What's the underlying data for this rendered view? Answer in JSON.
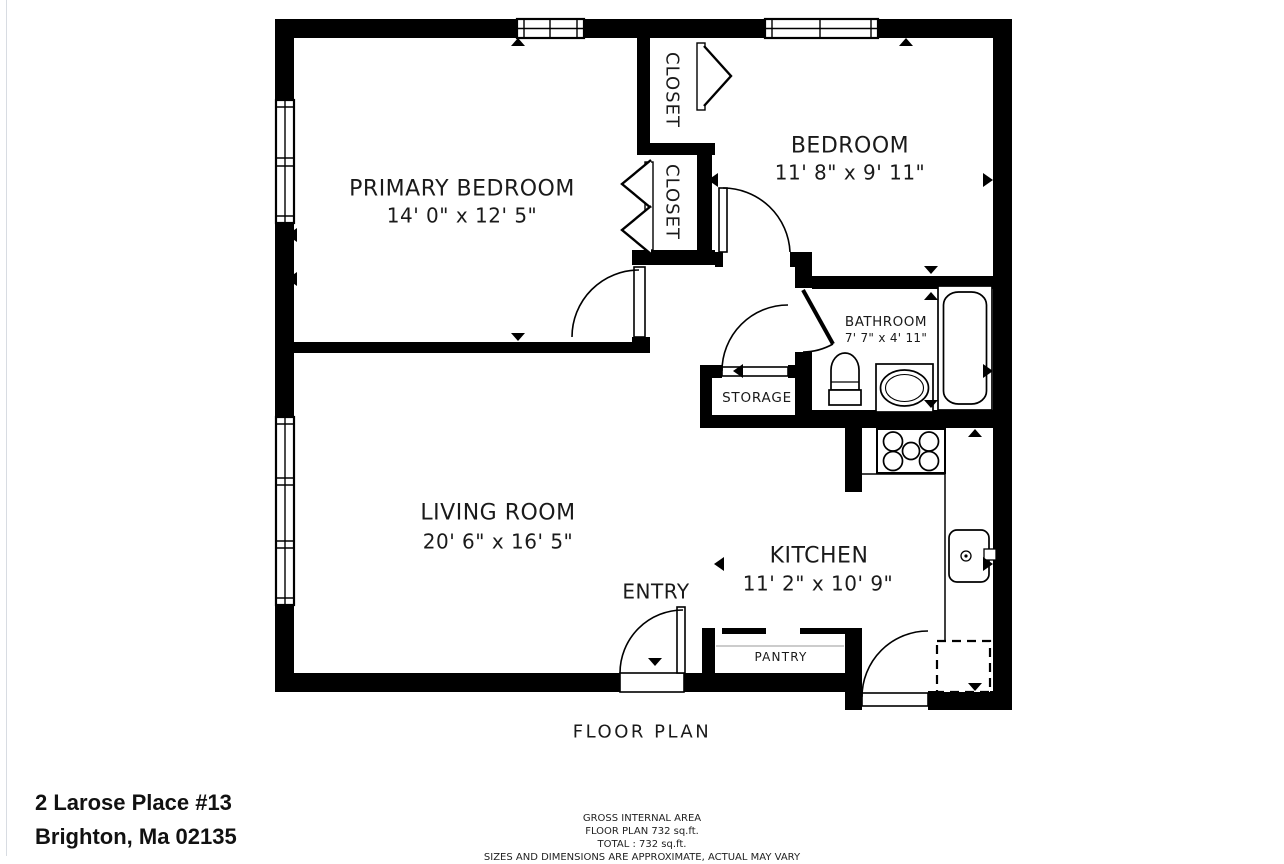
{
  "address": {
    "line1": "2 Larose Place #13",
    "line2": "Brighton, Ma 02135"
  },
  "plan": {
    "title": "FLOOR PLAN"
  },
  "rooms": {
    "primary_bedroom": {
      "name": "PRIMARY BEDROOM",
      "dimensions": "14' 0\" x 12' 5\""
    },
    "bedroom": {
      "name": "BEDROOM",
      "dimensions": "11' 8\" x 9' 11\""
    },
    "bathroom": {
      "name": "BATHROOM",
      "dimensions": "7' 7\" x 4' 11\""
    },
    "living_room": {
      "name": "LIVING ROOM",
      "dimensions": "20' 6\" x 16' 5\""
    },
    "kitchen": {
      "name": "KITCHEN",
      "dimensions": "11' 2\" x 10' 9\""
    },
    "closet_top": {
      "name": "CLOSET"
    },
    "closet_bottom": {
      "name": "CLOSET"
    },
    "storage": {
      "name": "STORAGE"
    },
    "pantry": {
      "name": "PANTRY"
    },
    "entry": {
      "name": "ENTRY"
    }
  },
  "area_summary": {
    "line1": "GROSS INTERNAL AREA",
    "line2": "FLOOR PLAN 732 sq.ft.",
    "line3": "TOTAL :  732 sq.ft.",
    "line4": "SIZES AND DIMENSIONS ARE APPROXIMATE, ACTUAL MAY VARY"
  },
  "colors": {
    "wall": "#000000",
    "text": "#1a1a1a",
    "page_edge": "#d8dce2"
  }
}
